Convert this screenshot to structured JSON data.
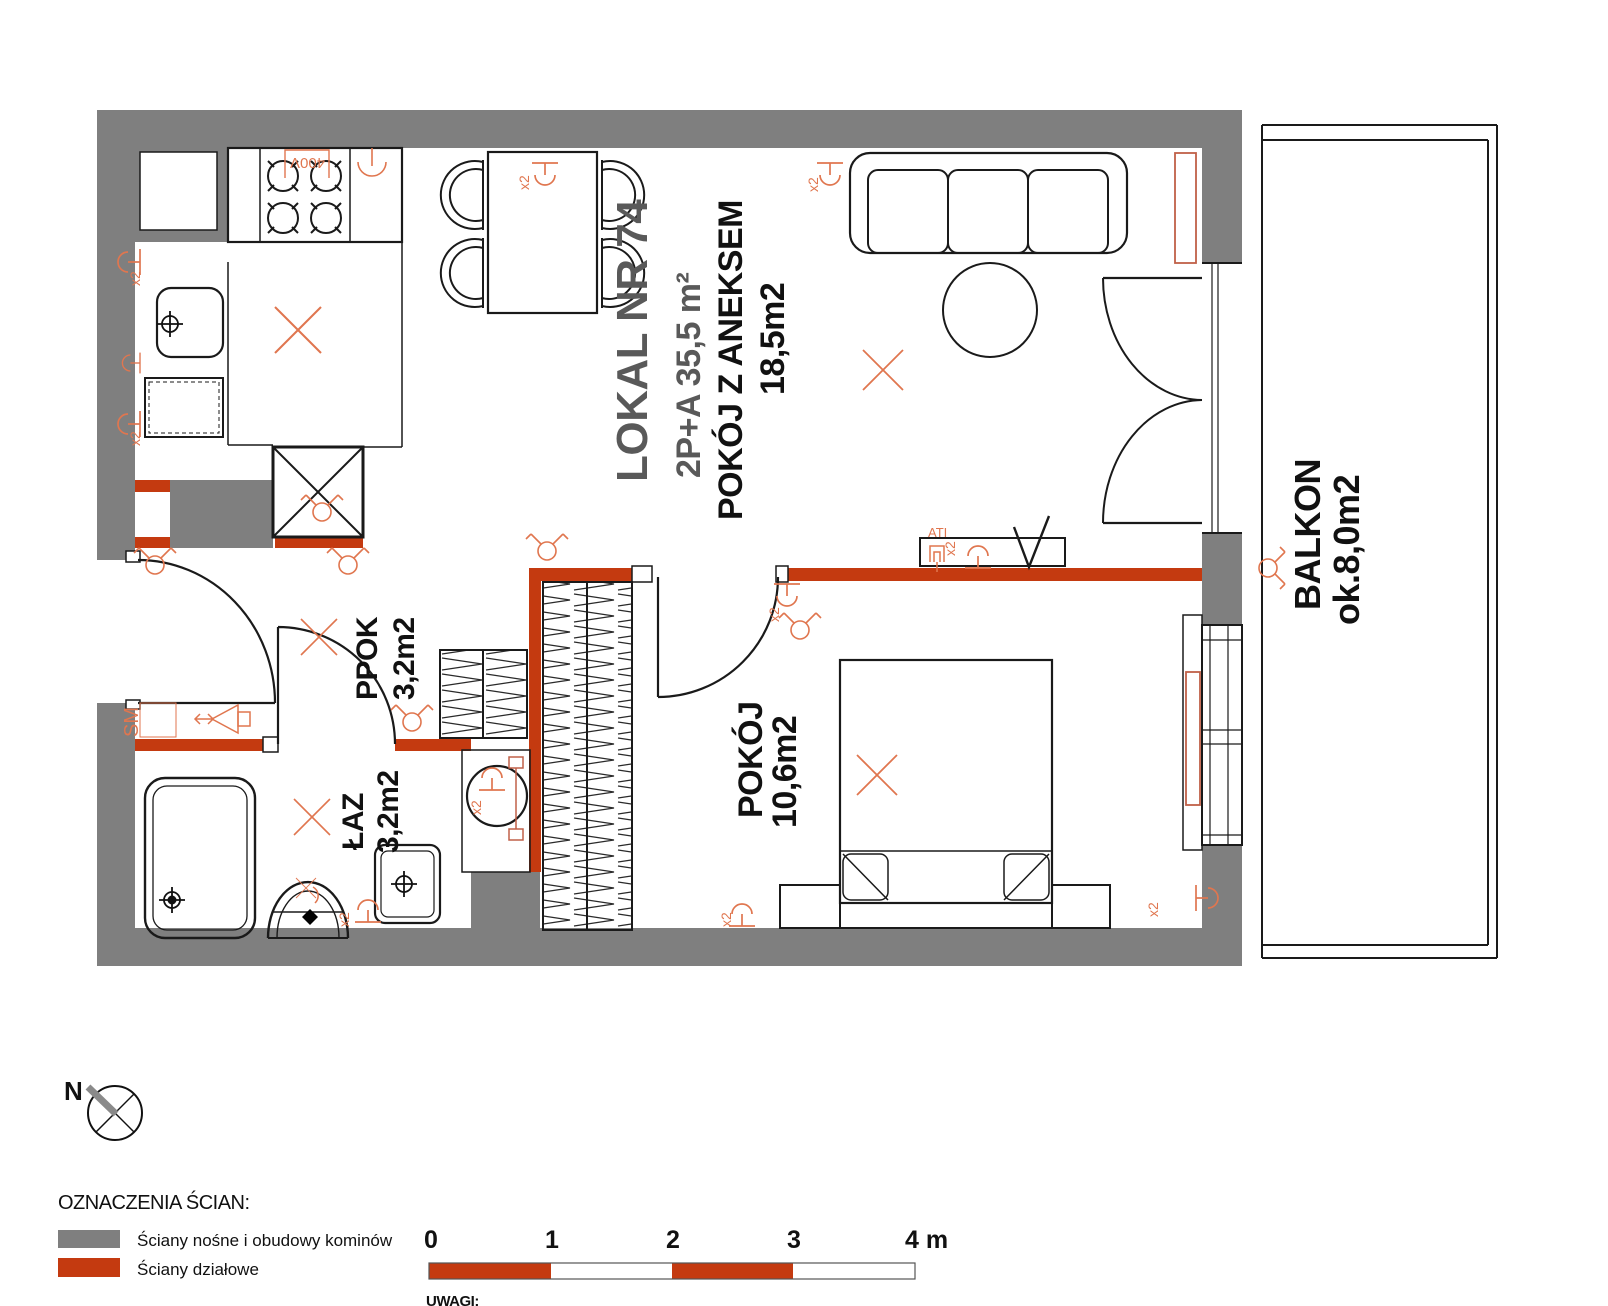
{
  "unit": {
    "title": "LOKAL NR 74",
    "type_area": "2P+A   35,5 m²"
  },
  "rooms": {
    "living": {
      "name": "POKÓJ  Z  ANEKSEM",
      "area": "18,5m2"
    },
    "bedroom": {
      "name": "POKÓJ",
      "area": "10,6m2"
    },
    "hall": {
      "name": "PPOK",
      "area": "3,2m2"
    },
    "bath": {
      "name": "ŁAZ",
      "area": "3,2m2"
    },
    "balcony": {
      "name": "BALKON",
      "area": "ok.8,0m2"
    }
  },
  "legend": {
    "heading": "OZNACZENIA ŚCIAN:",
    "load_bearing": "Ściany nośne i obudowy kominów",
    "partition": "Ściany działowe"
  },
  "scale_bar": {
    "ticks": [
      "0",
      "1",
      "2",
      "3"
    ],
    "end_label": "4 m"
  },
  "compass": {
    "north": "N"
  },
  "notes": {
    "heading": "UWAGI:"
  },
  "symbols": {
    "double_socket": "x2",
    "stove_power": "400V",
    "intercom": "SM",
    "tv_socket": "ATI"
  },
  "colors": {
    "load_bearing_wall": "#7F7F7F",
    "partition_wall": "#C43A10",
    "electric_symbol": "#E0764F",
    "radiator": "#C06048"
  }
}
